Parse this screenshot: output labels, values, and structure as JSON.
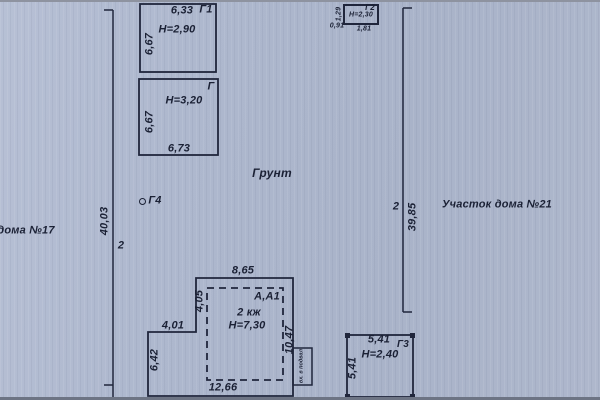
{
  "plan": {
    "ground": "Грунт",
    "left_plot": "дома №17",
    "right_plot": "Участок дома №21",
    "left_boundary": {
      "length": "40,03",
      "point": "2"
    },
    "right_boundary": {
      "length": "39,85",
      "point": "2"
    },
    "marker_g4": "Г4",
    "g1": {
      "name": "Г1",
      "top": "6,33",
      "height": "Н=2,90",
      "left": "6,67"
    },
    "g": {
      "name": "Г",
      "height": "Н=3,20",
      "left": "6,67",
      "bottom": "6,73"
    },
    "g2": {
      "name": "Г2",
      "height": "Н=2,30",
      "left": "1,29",
      "bottom_left": "0,91",
      "bottom": "1,81"
    },
    "main": {
      "name": "А,А1",
      "floors": "2 кж",
      "height": "Н=7,30",
      "top": "8,65",
      "left_upper": "4,05",
      "ledge": "4,01",
      "left_lower": "6,42",
      "right": "10,47",
      "bottom": "12,66",
      "basement_entry": "вх. в подвал"
    },
    "g3": {
      "name": "Г3",
      "height": "Н=2,40",
      "top": "5,41",
      "left": "5,41"
    }
  }
}
